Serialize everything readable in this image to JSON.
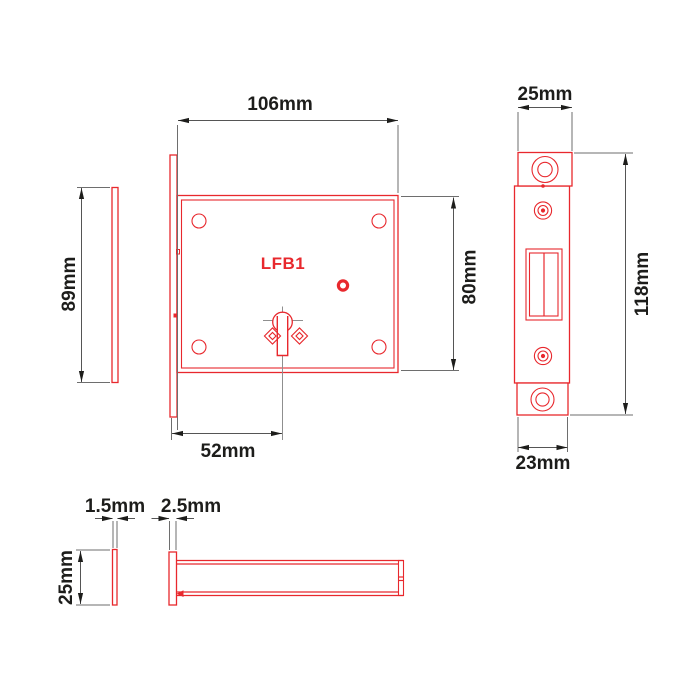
{
  "drawing": {
    "product_code": "LFB1",
    "views": {
      "case_front": {
        "code_label": "LFB1",
        "width": "106mm",
        "height": "80mm",
        "keyhole_backset": "52mm"
      },
      "strike_plate_side": {
        "height": "89mm"
      },
      "forend_front": {
        "top_width": "25mm",
        "height": "118mm",
        "bottom_width": "23mm"
      },
      "strike_plate_edge": {
        "thickness": "1.5mm",
        "depth": "25mm"
      },
      "case_top": {
        "forend_thickness": "2.5mm"
      }
    },
    "colors": {
      "part_outline": "#e8282d",
      "dimension_lines": "#555555",
      "extension_lines": "#6e6e6e",
      "arrows_and_text": "#1d1d1b",
      "background": "#ffffff"
    }
  }
}
